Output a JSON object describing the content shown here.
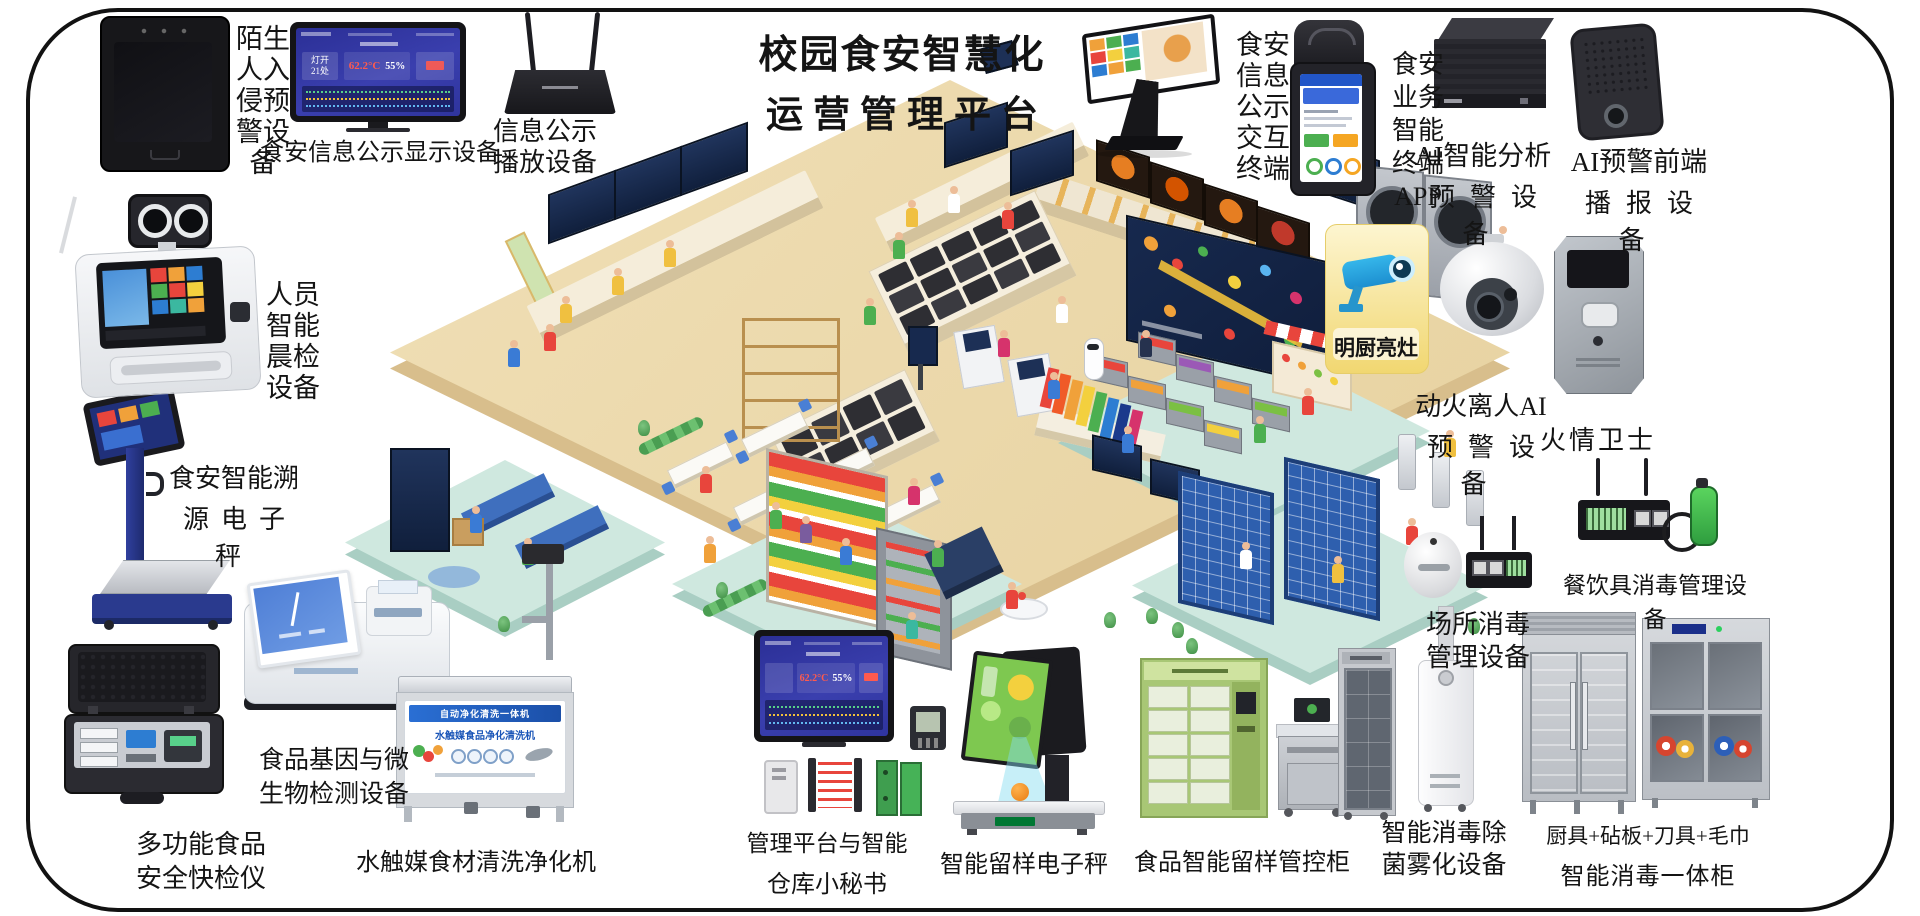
{
  "title": {
    "line1": "校园食安智慧化",
    "line2": "运营管理平台"
  },
  "dashboard": {
    "lamp1": "灯开",
    "lamp2": "21处",
    "temp": "62.2°C",
    "humidity": "55%"
  },
  "labels": {
    "stranger_alarm": "陌生人入侵预警设备",
    "info_display": "食安信息公示显示设备",
    "info_player": [
      "信息公示",
      "播放设备"
    ],
    "interactive_terminal": "食安信息公示交互终端",
    "app_terminal": [
      "食安",
      "业务",
      "智能",
      "终端",
      "APP"
    ],
    "ai_analysis": [
      "AI智能分析",
      "预警设备"
    ],
    "ai_broadcast": [
      "AI预警前端",
      "播报设备"
    ],
    "bright_kitchen": "明厨亮灶",
    "fire_ai": [
      "动火离人AI",
      "预警设备"
    ],
    "fire_guard": "火情卫士",
    "tableware_disinfect": "餐饮具消毒管理设备",
    "place_disinfect": [
      "场所消毒",
      "管理设备"
    ],
    "fog_disinfect": [
      "智能消毒除",
      "菌雾化设备"
    ],
    "combo_cabinet": [
      "厨具+砧板+刀具+毛巾",
      "智能消毒一体柜"
    ],
    "sample_cabinet": "食品智能留样管控柜",
    "sample_scale": "智能留样电子秤",
    "mgmt_platform": [
      "管理平台与智能",
      "仓库小秘书"
    ],
    "washer": "水触媒食材清洗净化机",
    "gene_test": [
      "食品基因与微",
      "生物检测设备"
    ],
    "rapid_test": [
      "多功能食品",
      "安全快检仪"
    ],
    "trace_scale": [
      "食安智能溯",
      "源电子秤"
    ],
    "morning_check": "人员智能晨检设备"
  },
  "washer_panel": {
    "banner1": "自动净化清洗一体机",
    "banner2": "水触媒食品净化清洗机"
  }
}
